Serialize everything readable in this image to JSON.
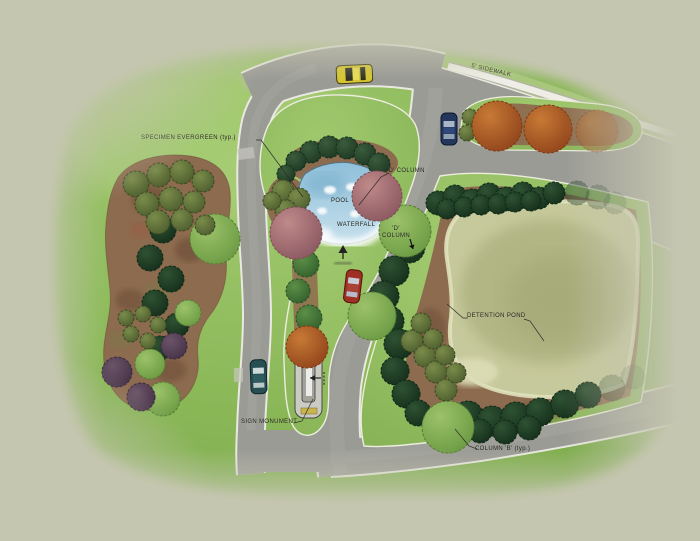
{
  "plan": {
    "labels": {
      "specimen_evergreen": "SPECIMEN EVERGREEN (typ.)",
      "sidewalk": "5' SIDEWALK",
      "id_column_upper": "'D' COLUMN",
      "id_column_lower": "'D' COLUMN",
      "pool": "POOL",
      "waterfall": "WATERFALL",
      "detention_pond": "DETENTION POND",
      "sign_monument": "SIGN MONUMENT",
      "column_b": "COLUMN 'B' (typ.)"
    },
    "palette": {
      "background": "#c5c6b0",
      "lawn": "#8ab757",
      "road": "#9b9b96",
      "curb": "#ececdf",
      "mulch": "#8d6b4f",
      "pool_water": "#a9d0e4",
      "pond": "#c6c99b",
      "evergreen": "#24432a",
      "canopy_light": "#7fae52",
      "canopy_mauve": "#b07578",
      "canopy_orange": "#b5622a",
      "shrub_purple": "#5a4456"
    },
    "vehicles": [
      {
        "name": "car-yellow",
        "color": "#d6c52e"
      },
      {
        "name": "car-blue",
        "color": "#24365c"
      },
      {
        "name": "car-red",
        "color": "#9e3024"
      },
      {
        "name": "car-teal",
        "color": "#274e52"
      }
    ]
  }
}
